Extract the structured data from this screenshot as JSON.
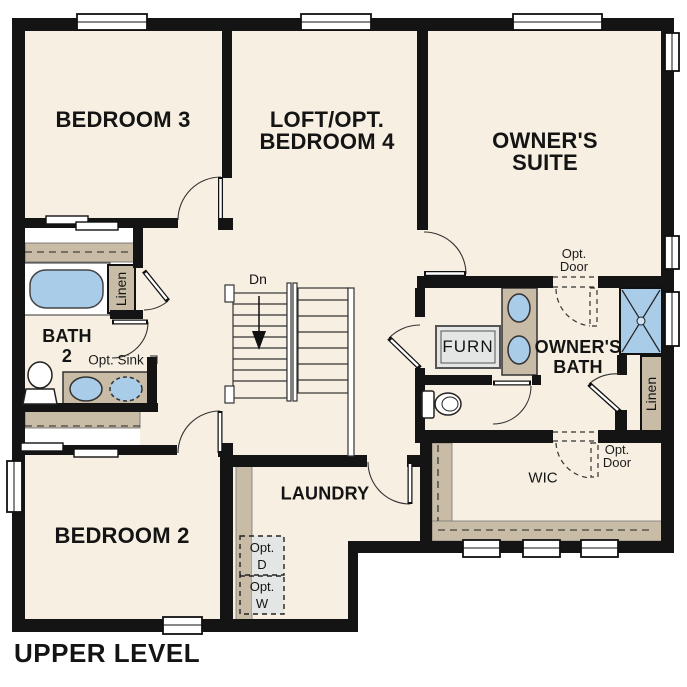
{
  "title": "UPPER LEVEL",
  "rooms": {
    "bedroom3": "BEDROOM 3",
    "loft": [
      "LOFT/OPT.",
      "BEDROOM 4"
    ],
    "owners_suite": [
      "OWNER'S",
      "SUITE"
    ],
    "bedroom2": "BEDROOM 2",
    "bath2": [
      "BATH",
      "2"
    ],
    "owners_bath": [
      "OWNER'S",
      "BATH"
    ],
    "laundry": "LAUNDRY",
    "wic": "WIC"
  },
  "features": {
    "linen": "Linen",
    "stairs_down": "Dn",
    "furnace": "FURN",
    "opt_sink": "Opt. Sink",
    "opt_door": [
      "Opt.",
      "Door"
    ],
    "opt_dryer": [
      "Opt.",
      "D"
    ],
    "opt_washer": [
      "Opt.",
      "W"
    ]
  },
  "colors": {
    "wall": "#141414",
    "floor": "#f7efe2",
    "counter_tan": "#c9bca6",
    "fixture_blue": "#a9cce9",
    "appliance_gray": "#e3e6e5",
    "outline": "#333333"
  }
}
